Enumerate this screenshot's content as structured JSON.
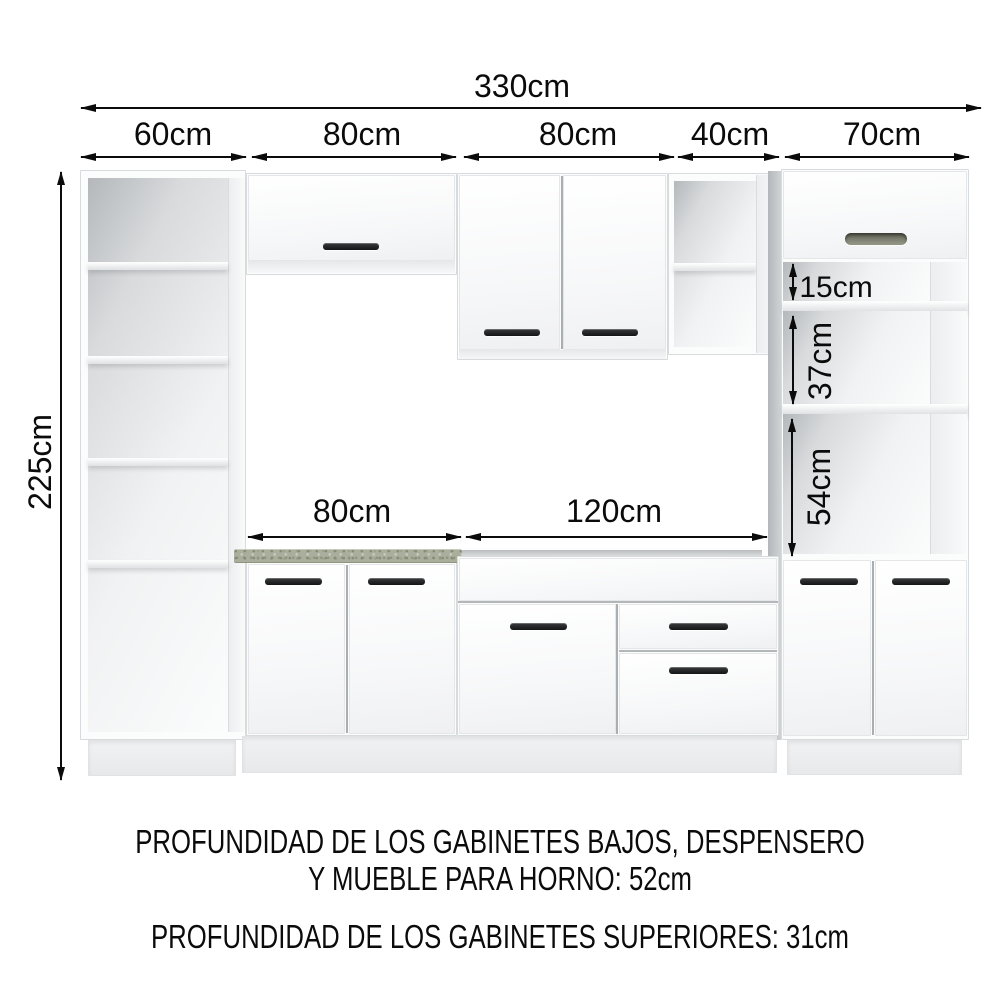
{
  "dimensions": {
    "total_width": "330cm",
    "height": "225cm",
    "top_segments": [
      "60cm",
      "80cm",
      "80cm",
      "40cm",
      "70cm"
    ],
    "counter_segments": [
      "80cm",
      "120cm"
    ],
    "tower_compartments": [
      "15cm",
      "37cm",
      "54cm"
    ]
  },
  "notes": {
    "line1": "PROFUNDIDAD DE LOS GABINETES BAJOS, DESPENSERO",
    "line2": "Y MUEBLE PARA HORNO: 52cm",
    "line3": "PROFUNDIDAD DE LOS GABINETES SUPERIORES: 31cm"
  },
  "colors": {
    "background": "#ffffff",
    "line": "#0b0b0b",
    "cabinet_face": "#f8f9fa",
    "cabinet_edge": "#d8dbdd",
    "countertop": "#a9ae9d",
    "handle": "#1d1e1f",
    "recessed_handle": "#85887a",
    "plinth": "#eef0f1"
  }
}
